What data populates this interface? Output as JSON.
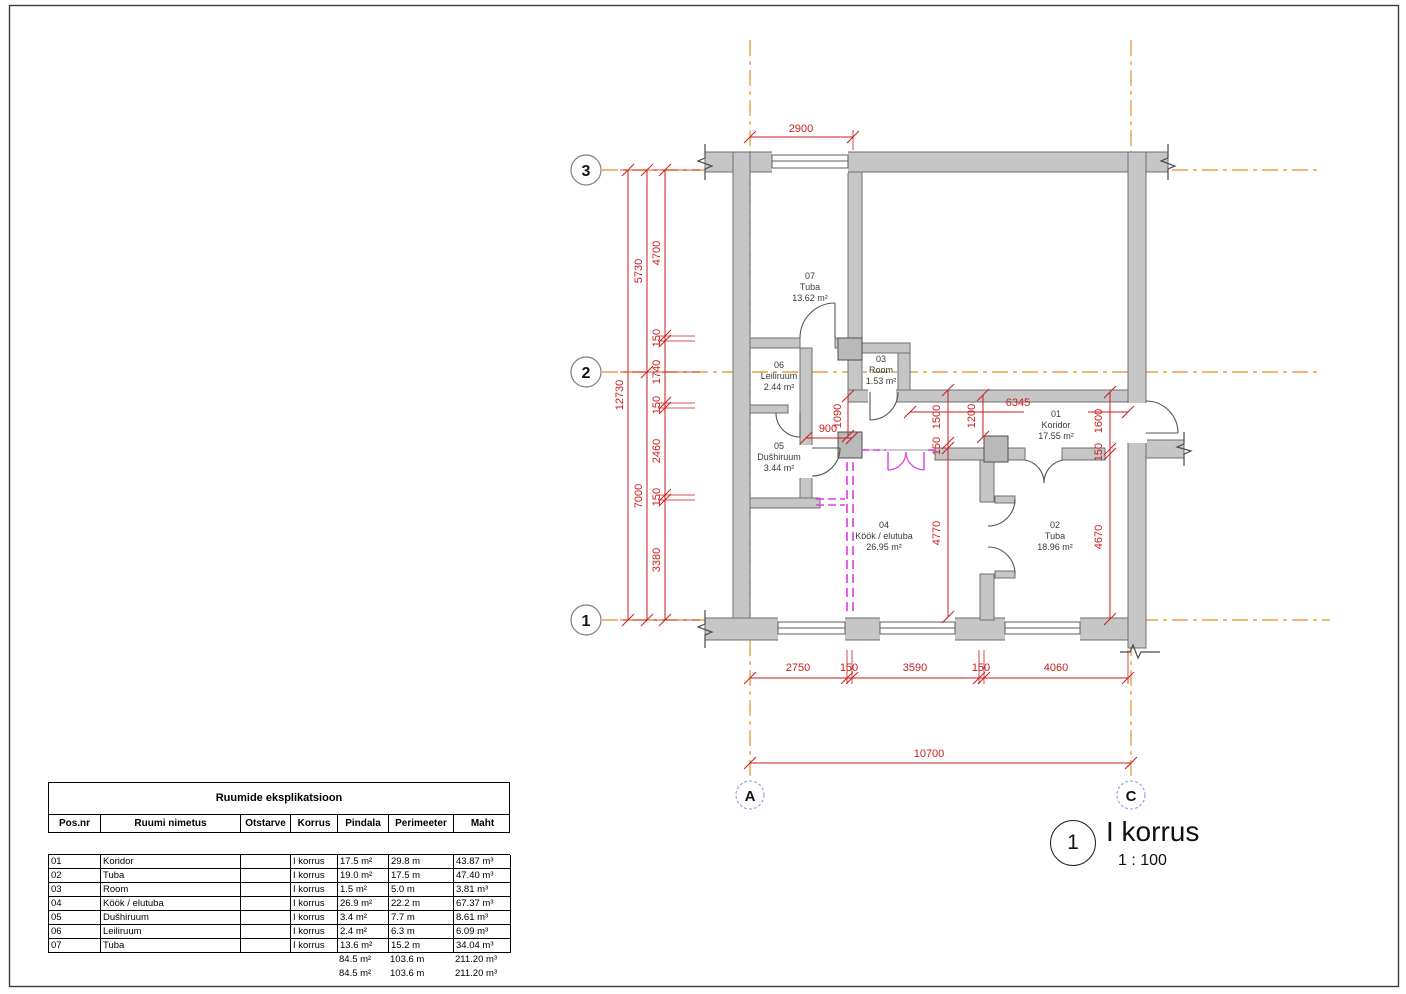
{
  "view_title": {
    "marker": "1",
    "name": "I korrus",
    "scale": "1 : 100"
  },
  "grid": {
    "h": [
      "3",
      "2",
      "1"
    ],
    "v": [
      "A",
      "C"
    ]
  },
  "rooms": [
    {
      "number": "01",
      "name": "Koridor",
      "area": "17.55 m²"
    },
    {
      "number": "02",
      "name": "Tuba",
      "area": "18.96 m²"
    },
    {
      "number": "03",
      "name": "Room",
      "area": "1.53 m²"
    },
    {
      "number": "04",
      "name": "Köök / elutuba",
      "area": "26.95 m²"
    },
    {
      "number": "05",
      "name": "Dušhiruum",
      "area": "3.44 m²"
    },
    {
      "number": "06",
      "name": "Leiliruum",
      "area": "2.44 m²"
    },
    {
      "number": "07",
      "name": "Tuba",
      "area": "13.62 m²"
    }
  ],
  "dims": {
    "top_window": "2900",
    "left_total": "12730",
    "left_seg_a": "5730",
    "left_seg_b": "7000",
    "left_c1": "4700",
    "left_c2": "150",
    "left_c3": "1740",
    "left_c4": "150",
    "left_c5": "2460",
    "left_c6": "150",
    "left_c7": "3380",
    "d900": "900",
    "d1090": "1090",
    "d1500": "1500",
    "d150_mid": "150",
    "d4770": "4770",
    "d1200": "1200",
    "d6345": "6345",
    "d1600": "1600",
    "d150_right": "150",
    "d4670": "4670",
    "bot_1": "2750",
    "bot_2": "150",
    "bot_3": "3590",
    "bot_4": "150",
    "bot_5": "4060",
    "bot_total": "10700"
  },
  "schedule": {
    "title": "Ruumide eksplikatsioon",
    "headers": [
      "Pos.nr",
      "Ruumi nimetus",
      "Otstarve",
      "Korrus",
      "Pindala",
      "Perimeeter",
      "Maht"
    ],
    "rows": [
      [
        "01",
        "Koridor",
        "",
        "I korrus",
        "17.5 m²",
        "29.8 m",
        "43.87 m³"
      ],
      [
        "02",
        "Tuba",
        "",
        "I korrus",
        "19.0 m²",
        "17.5 m",
        "47.40 m³"
      ],
      [
        "03",
        "Room",
        "",
        "I korrus",
        "1.5 m²",
        "5.0 m",
        "3.81 m³"
      ],
      [
        "04",
        "Köök / elutuba",
        "",
        "I korrus",
        "26.9 m²",
        "22.2 m",
        "67.37 m³"
      ],
      [
        "05",
        "Dušhiruum",
        "",
        "I korrus",
        "3.4 m²",
        "7.7 m",
        "8.61 m³"
      ],
      [
        "06",
        "Leiliruum",
        "",
        "I korrus",
        "2.4 m²",
        "6.3 m",
        "6.09 m³"
      ],
      [
        "07",
        "Tuba",
        "",
        "I korrus",
        "13.6 m²",
        "15.2 m",
        "34.04 m³"
      ]
    ],
    "totals": [
      [
        "",
        "",
        "",
        "",
        "84.5 m²",
        "103.6 m",
        "211.20 m³"
      ],
      [
        "",
        "",
        "",
        "",
        "84.5 m²",
        "103.6 m",
        "211.20 m³"
      ]
    ]
  },
  "colors": {
    "dimension_red": "#c81e1e",
    "grid_orange": "#e8a145",
    "wall_gray": "#c6c6c6",
    "new_wall_magenta": "#e03ae0"
  }
}
